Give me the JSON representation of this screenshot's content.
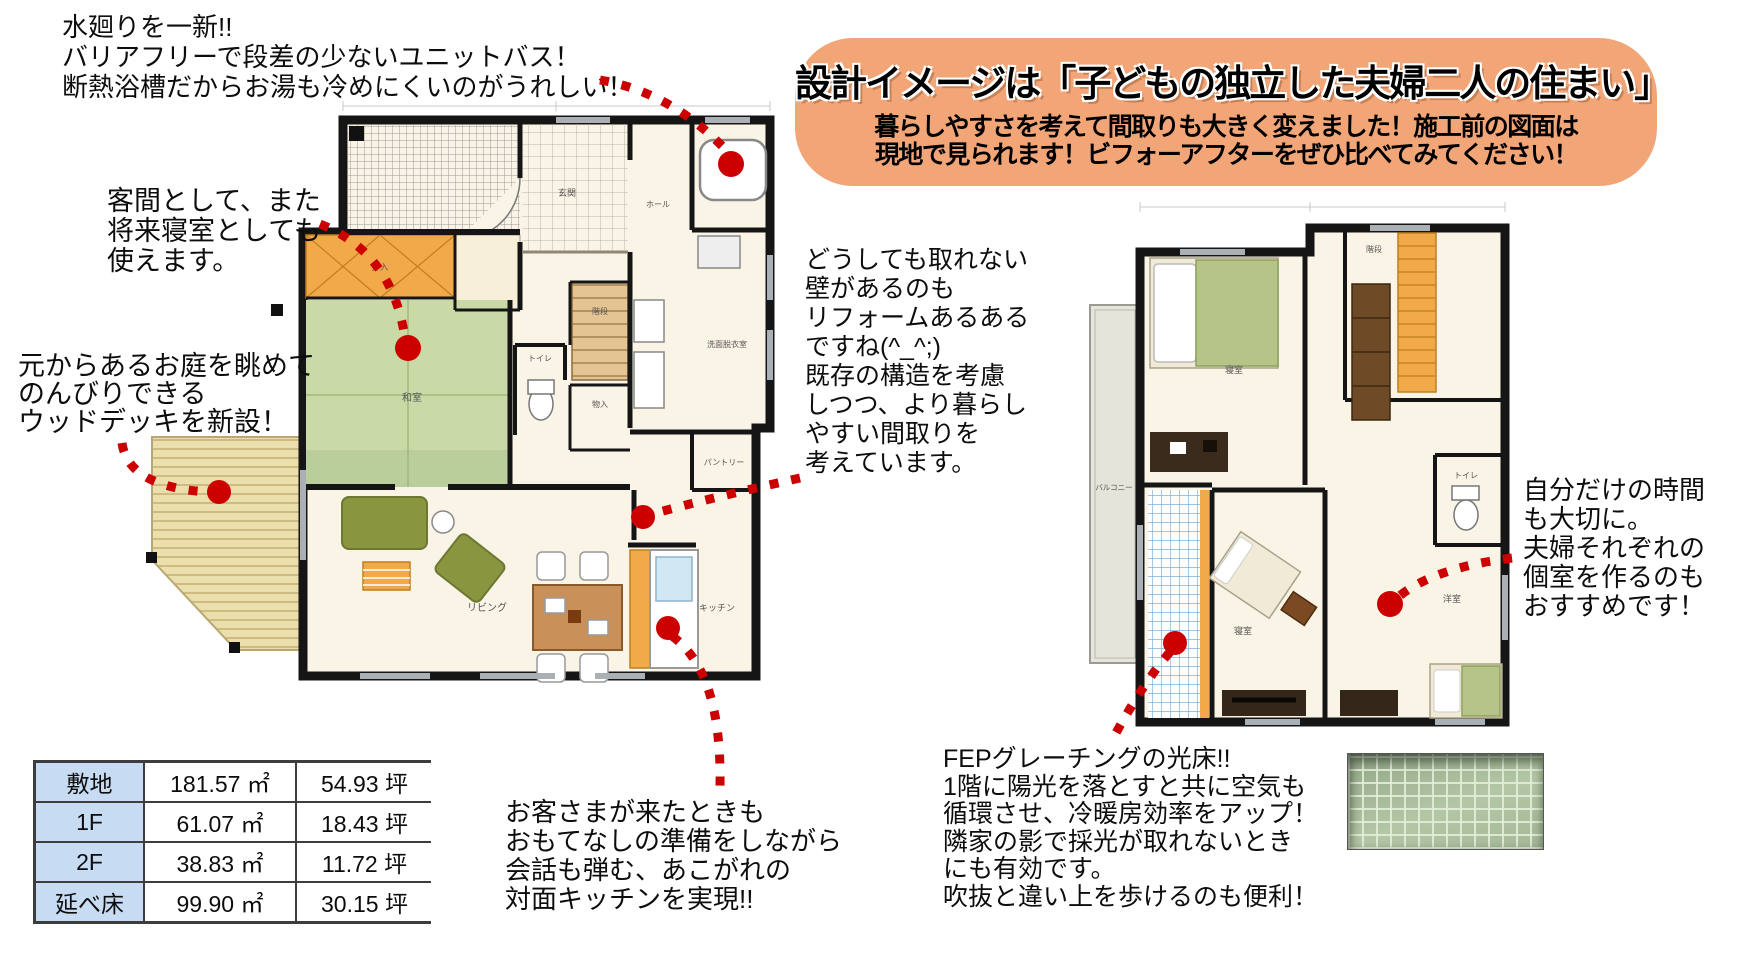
{
  "banner": {
    "title": "設計イメージは「子どもの独立した夫婦二人の住まい」",
    "subtitle_line1": "暮らしやすさを考えて間取りも大きく変えました！施工前の図面は",
    "subtitle_line2": "現地で見られます！ビフォーアフターをぜひ比べてみてください！",
    "bg_color": "#F2A678"
  },
  "annotations": {
    "unit_bath": {
      "lines": [
        "水廻りを一新!!",
        "バリアフリーで段差の少ないユニットバス！",
        "断熱浴槽だからお湯も冷めにくいのがうれしい！"
      ]
    },
    "guest_room": {
      "lines": [
        "客間として、また",
        "将来寝室としても",
        "使えます。"
      ]
    },
    "wood_deck": {
      "lines": [
        "元からあるお庭を眺めて",
        "のんびりできる",
        "ウッドデッキを新設！"
      ]
    },
    "existing_wall": {
      "lines": [
        "どうしても取れない",
        "壁があるのも",
        "リフォームあるある",
        "ですね(^_^;)",
        "既存の構造を考慮",
        "しつつ、より暮らし",
        "やすい間取りを",
        "考えています。"
      ]
    },
    "open_kitchen": {
      "lines": [
        "お客さまが来たときも",
        "おもてなしの準備をしながら",
        "会話も弾む、あこがれの",
        "対面キッチンを実現!!"
      ]
    },
    "private_rooms": {
      "lines": [
        "自分だけの時間",
        "も大切に。",
        "夫婦それぞれの",
        "個室を作るのも",
        "おすすめです！"
      ]
    },
    "fep_grating": {
      "lines": [
        "FEPグレーチングの光床!!",
        "1階に陽光を落とすと共に空気も",
        "循環させ、冷暖房効率をアップ！",
        "隣家の影で採光が取れないとき",
        "にも有効です。",
        "吹抜と違い上を歩けるのも便利！"
      ]
    }
  },
  "area_table": {
    "rows": [
      {
        "label": "敷地",
        "m2": "181.57 ㎡",
        "tsubo": "54.93 坪"
      },
      {
        "label": "1F",
        "m2": "61.07 ㎡",
        "tsubo": "18.43 坪"
      },
      {
        "label": "2F",
        "m2": "38.83 ㎡",
        "tsubo": "11.72 坪"
      },
      {
        "label": "延べ床",
        "m2": "99.90 ㎡",
        "tsubo": "30.15 坪"
      }
    ],
    "header_bg": "#C7DBF2"
  },
  "floor_plan_1f": {
    "labels": {
      "genkan": "玄関",
      "hall": "ホール",
      "stairs": "階段",
      "washroom": "洗面脱衣室",
      "toilet": "トイレ",
      "storage": "物入",
      "closet": "押入",
      "tatami": "和室",
      "pantry": "パントリー",
      "living": "リビング",
      "kitchen": "キッチン"
    }
  },
  "floor_plan_2f": {
    "labels": {
      "bedroom1": "寝室",
      "bedroom2": "寝室",
      "western_room": "洋室",
      "balcony": "バルコニー",
      "toilet": "トイレ",
      "stairs": "階段"
    }
  },
  "colors": {
    "annotation_red": "#CC0000",
    "banner_orange": "#F2A678",
    "table_header_blue": "#C7DBF2",
    "tatami_green": "#C9DAA7",
    "closet_orange": "#F2A94A",
    "fep_grid_blue": "#7FB2DC",
    "wall_black": "#151515",
    "deck_tan": "#EBDFAD"
  }
}
